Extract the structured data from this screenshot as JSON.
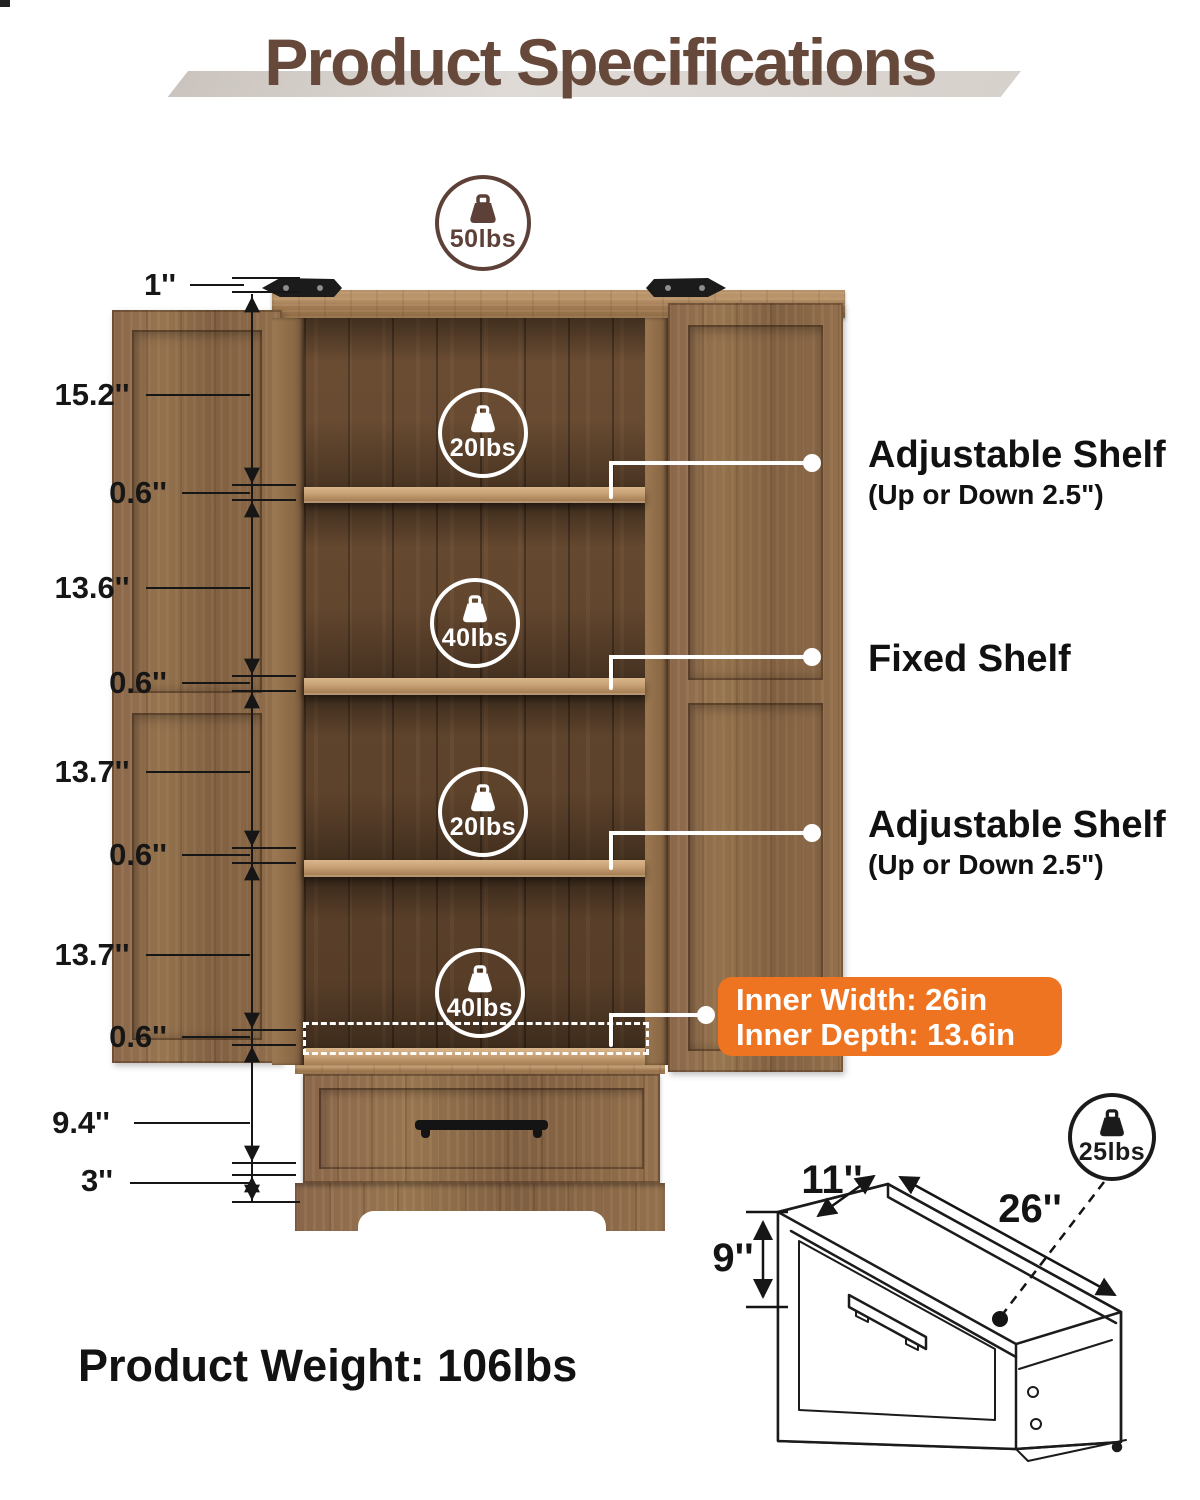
{
  "title": "Product Specifications",
  "product_weight": "Product Weight: 106lbs",
  "weight_badges": {
    "top": "50lbs",
    "compartment1": "20lbs",
    "compartment2": "40lbs",
    "compartment3": "20lbs",
    "compartment4": "40lbs",
    "drawer": "25lbs"
  },
  "left_dimensions": [
    "1''",
    "15.2''",
    "0.6''",
    "13.6''",
    "0.6''",
    "13.7''",
    "0.6''",
    "13.7''",
    "0.6''",
    "9.4''",
    "3''"
  ],
  "shelf_labels": {
    "adjustable_top_title": "Adjustable Shelf",
    "adjustable_top_sub": "(Up or Down 2.5\")",
    "fixed_title": "Fixed Shelf",
    "adjustable_bottom_title": "Adjustable Shelf",
    "adjustable_bottom_sub": "(Up or Down 2.5\")"
  },
  "inner_dimensions": {
    "width": "Inner Width: 26in",
    "depth": "Inner Depth: 13.6in"
  },
  "drawer_dimensions": {
    "depth": "11''",
    "length": "26''",
    "height": "9''"
  },
  "colors": {
    "accent_orange": "#EE7421",
    "title_brown": "#66493A",
    "badge_brown": "#5D4037"
  }
}
